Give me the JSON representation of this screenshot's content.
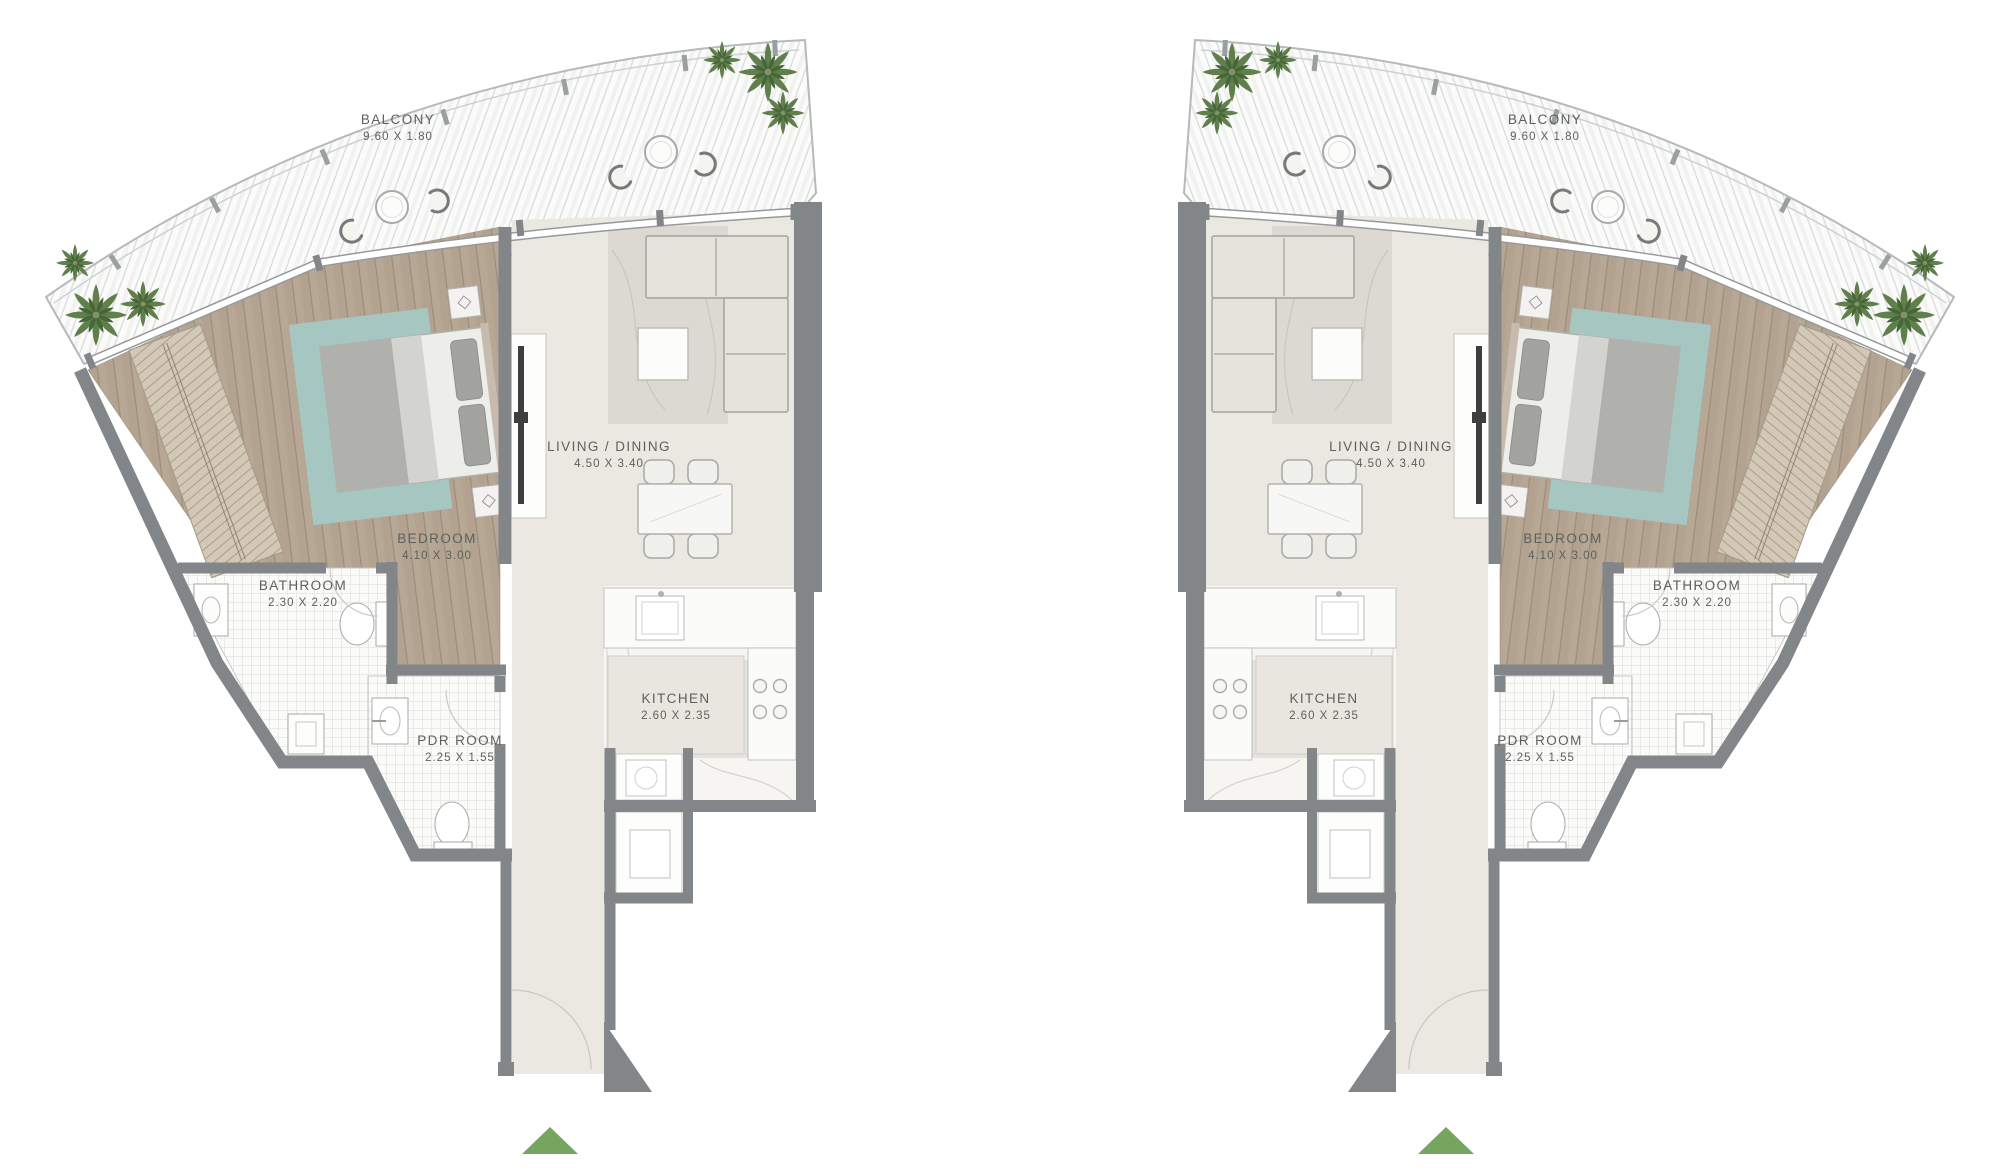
{
  "plans": [
    {
      "side": "left",
      "rooms": [
        {
          "id": "balcony",
          "name": "BALCONY",
          "size": "9.60 X 1.80"
        },
        {
          "id": "living",
          "name": "LIVING / DINING",
          "size": "4.50 X 3.40"
        },
        {
          "id": "bedroom",
          "name": "BEDROOM",
          "size": "4.10 X 3.00"
        },
        {
          "id": "bathroom",
          "name": "BATHROOM",
          "size": "2.30 X 2.20"
        },
        {
          "id": "kitchen",
          "name": "KITCHEN",
          "size": "2.60 X 2.35"
        },
        {
          "id": "pdr",
          "name": "PDR ROOM",
          "size": "2.25 X 1.55"
        }
      ],
      "entry_marker": "green-triangle"
    },
    {
      "side": "right",
      "rooms": [
        {
          "id": "balcony",
          "name": "BALCONY",
          "size": "9.60 X 1.80"
        },
        {
          "id": "living",
          "name": "LIVING / DINING",
          "size": "4.50 X 3.40"
        },
        {
          "id": "bedroom",
          "name": "BEDROOM",
          "size": "4.10 X 3.00"
        },
        {
          "id": "bathroom",
          "name": "BATHROOM",
          "size": "2.30 X 2.20"
        },
        {
          "id": "kitchen",
          "name": "KITCHEN",
          "size": "2.60 X 2.35"
        },
        {
          "id": "pdr",
          "name": "PDR ROOM",
          "size": "2.25 X 1.55"
        }
      ],
      "entry_marker": "green-triangle"
    }
  ],
  "colors": {
    "wall": "#838689",
    "label_text": "#5d615d",
    "entry_arrow": "#76a55f",
    "balcony_floor": "#fbfbfa",
    "bedroom_floor": "#b7a795",
    "living_floor": "#ebe8e1",
    "tile_floor": "#fbfbfa",
    "teal_rug": "#a6c6c1",
    "palm_green": "#5f7f4b"
  }
}
